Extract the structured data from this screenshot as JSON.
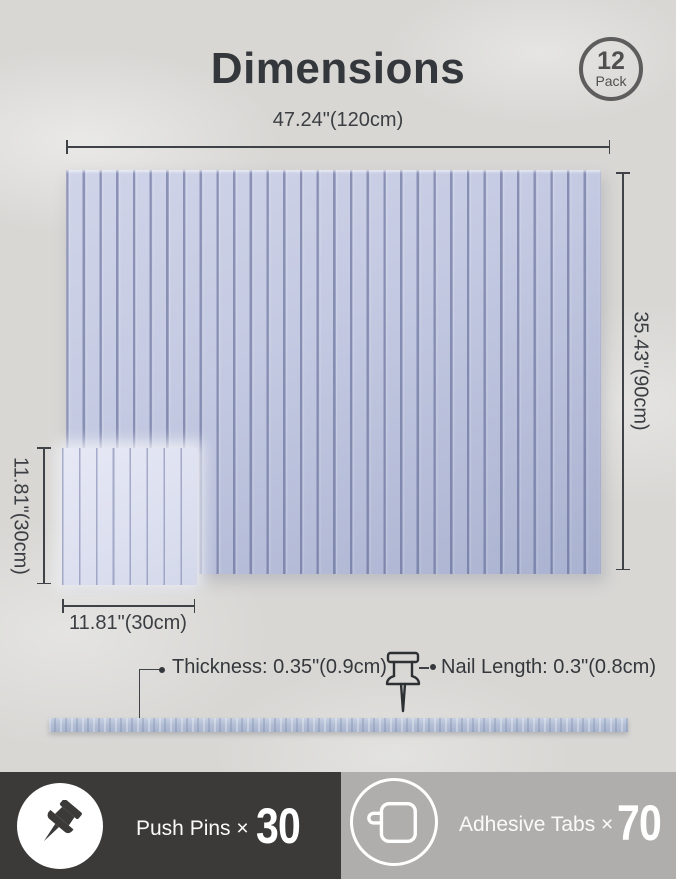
{
  "title": "Dimensions",
  "badge": {
    "count": "12",
    "unit": "Pack"
  },
  "diagram": {
    "large_panel": {
      "width_label": "47.24\"(120cm)",
      "height_label": "35.43\"(90cm)"
    },
    "small_panel": {
      "height_label": "11.81\"(30cm)",
      "width_label": "11.81\"(30cm)"
    },
    "thickness_label": "Thickness: 0.35\"(0.9cm)",
    "nail_label": "Nail Length: 0.3\"(0.8cm)"
  },
  "contents": {
    "push_pins": {
      "label": "Push Pins ×",
      "count": "30"
    },
    "adhesive_tabs": {
      "label": "Adhesive Tabs ×",
      "count": "70"
    }
  },
  "colors": {
    "panel": "#c5cbe3",
    "panel_groove": "#9096bb",
    "small_panel": "#dfe2f1",
    "edge_strip": "#b6c1d8",
    "footer_left_bg": "#3b3a39",
    "footer_right_bg": "#b0aeac",
    "text": "#34373b",
    "background": "#d8d7d4"
  }
}
